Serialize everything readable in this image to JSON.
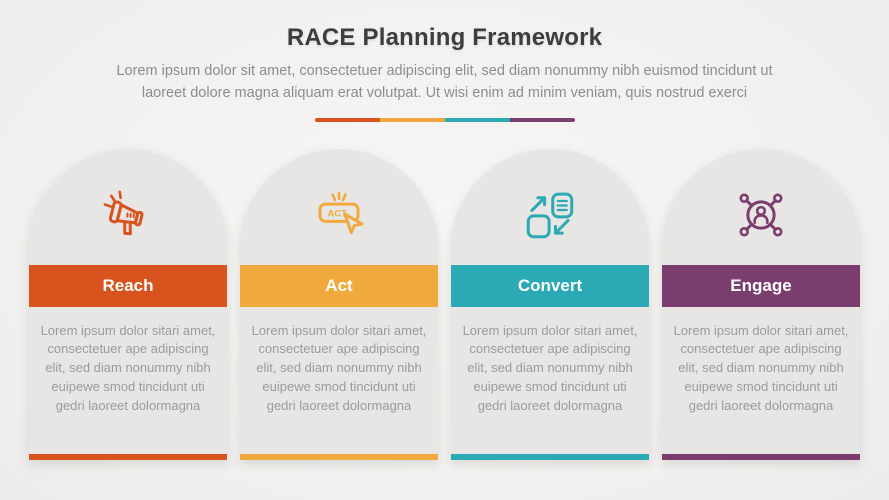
{
  "header": {
    "title": "RACE Planning Framework",
    "subtitle_line1": "Lorem ipsum dolor sit amet, consectetuer adipiscing elit, sed diam nonummy nibh euismod tincidunt ut",
    "subtitle_line2": "laoreet dolore magna aliquam erat volutpat. Ut wisi enim ad minim veniam, quis nostrud exerci"
  },
  "divider": {
    "colors": [
      "#d9531e",
      "#f0a93c",
      "#2ba9b4",
      "#7b3c6e"
    ]
  },
  "columns": [
    {
      "label": "Reach",
      "icon": "megaphone-icon",
      "color": "#d9531e",
      "body": "Lorem ipsum dolor sitari amet, consectetuer ape adipiscing elit, sed diam nonummy nibh euipewe smod tincidunt uti gedri laoreet dolormagna"
    },
    {
      "label": "Act",
      "icon": "act-button-cursor-icon",
      "icon_text": "ACT",
      "color": "#f0a93c",
      "body": "Lorem ipsum dolor sitari amet, consectetuer ape adipiscing elit, sed diam nonummy nibh euipewe smod tincidunt uti gedri laoreet dolormagna"
    },
    {
      "label": "Convert",
      "icon": "transfer-documents-icon",
      "color": "#2ba9b4",
      "body": "Lorem ipsum dolor sitari amet, consectetuer ape adipiscing elit, sed diam nonummy nibh euipewe smod tincidunt uti gedri laoreet dolormagna"
    },
    {
      "label": "Engage",
      "icon": "person-network-icon",
      "color": "#7b3c6e",
      "body": "Lorem ipsum dolor sitari amet, consectetuer ape adipiscing elit, sed diam nonummy nibh euipewe smod tincidunt uti gedri laoreet dolormagna"
    }
  ]
}
